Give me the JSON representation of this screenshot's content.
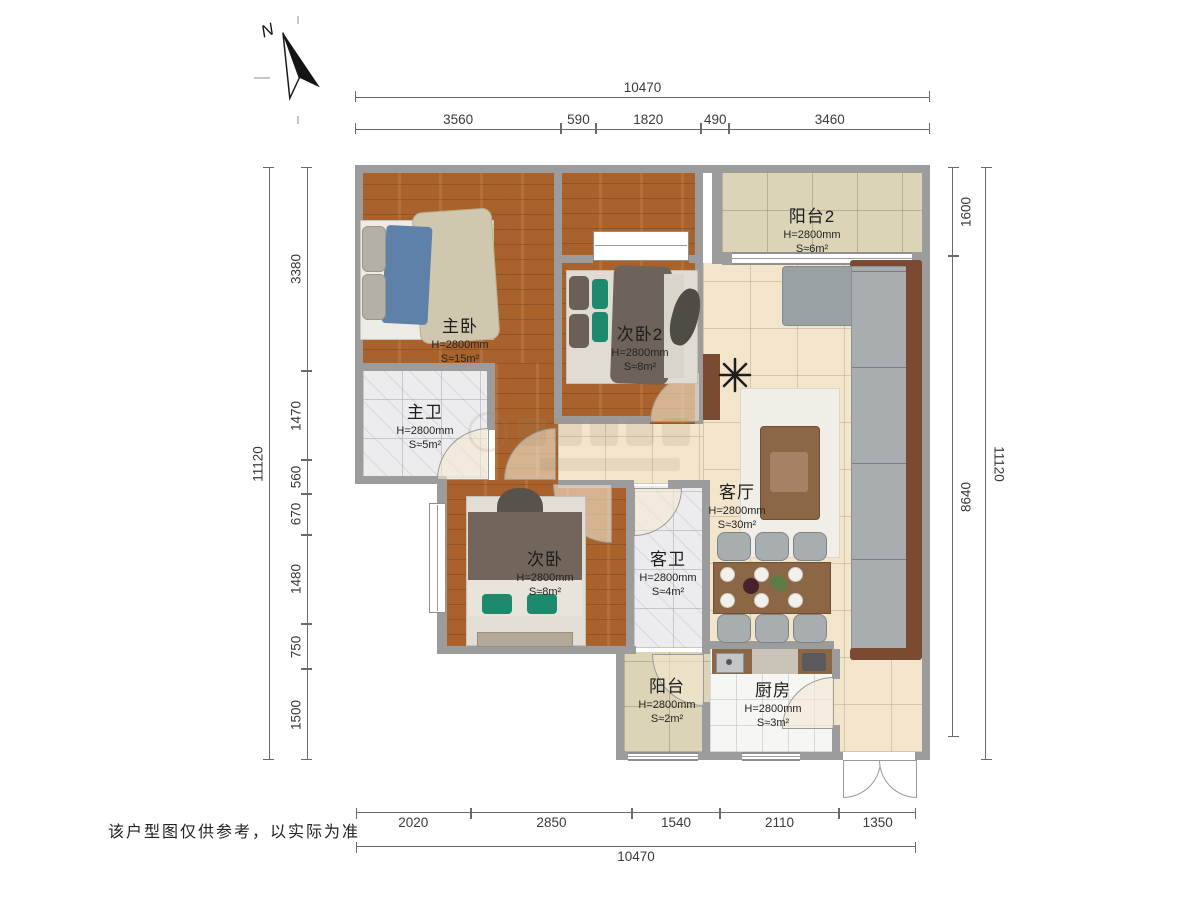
{
  "north_label": "N",
  "disclaimer": "该户型图仅供参考，以实际为准",
  "dims": {
    "top_total": [
      {
        "label": "10470",
        "v": 1
      }
    ],
    "top_segments": [
      {
        "label": "3560",
        "v": 3560
      },
      {
        "label": "590",
        "v": 590
      },
      {
        "label": "1820",
        "v": 1820
      },
      {
        "label": "490",
        "v": 490
      },
      {
        "label": "3460",
        "v": 3460
      }
    ],
    "bottom_segments": [
      {
        "label": "2020",
        "v": 2020
      },
      {
        "label": "2850",
        "v": 2850
      },
      {
        "label": "1540",
        "v": 1540
      },
      {
        "label": "2110",
        "v": 2110
      },
      {
        "label": "1350",
        "v": 1350
      }
    ],
    "bottom_total": [
      {
        "label": "10470",
        "v": 1
      }
    ],
    "left_total": [
      {
        "label": "11120",
        "v": 1
      }
    ],
    "left_segments": [
      {
        "label": "3380",
        "v": 3380
      },
      {
        "label": "1470",
        "v": 1470
      },
      {
        "label": "560",
        "v": 560
      },
      {
        "label": "670",
        "v": 670
      },
      {
        "label": "1480",
        "v": 1480
      },
      {
        "label": "750",
        "v": 750
      },
      {
        "label": "1500",
        "v": 1500
      }
    ],
    "right_segments": [
      {
        "label": "1600",
        "v": 1600
      },
      {
        "label": "8640",
        "v": 8640
      }
    ],
    "right_total": [
      {
        "label": "11120",
        "v": 1
      }
    ]
  },
  "rooms": [
    {
      "name": "主卧",
      "h": "H=2800mm",
      "s": "S≈15m²"
    },
    {
      "name": "次卧2",
      "h": "H=2800mm",
      "s": "S≈8m²"
    },
    {
      "name": "主卫",
      "h": "H=2800mm",
      "s": "S≈5m²"
    },
    {
      "name": "次卧",
      "h": "H=2800mm",
      "s": "S≈8m²"
    },
    {
      "name": "客卫",
      "h": "H=2800mm",
      "s": "S≈4m²"
    },
    {
      "name": "客厅",
      "h": "H=2800mm",
      "s": "S≈30m²"
    },
    {
      "name": "阳台2",
      "h": "H=2800mm",
      "s": "S≈6m²"
    },
    {
      "name": "阳台",
      "h": "H=2800mm",
      "s": "S≈2m²"
    },
    {
      "name": "厨房",
      "h": "H=2800mm",
      "s": "S≈3m²"
    }
  ]
}
